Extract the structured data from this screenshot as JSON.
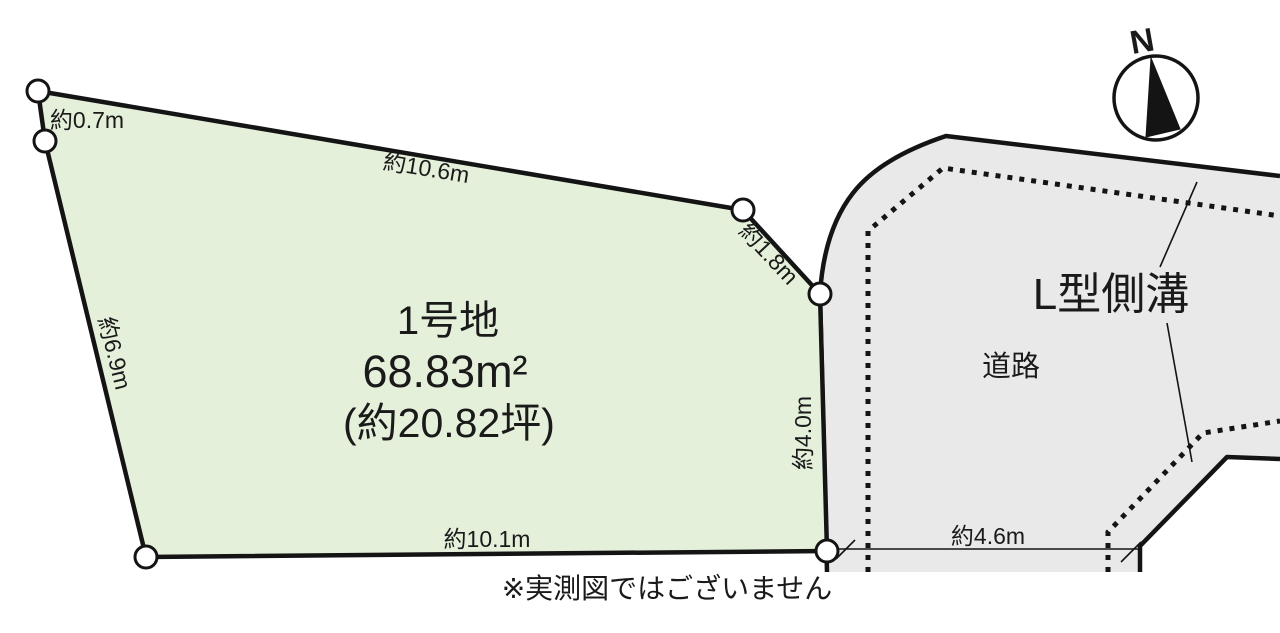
{
  "diagram": {
    "plot": {
      "name": "1号地",
      "area_m2": "68.83m²",
      "area_tsubo": "(約20.82坪)",
      "dimensions": {
        "top_left": "約0.7m",
        "top": "約10.6m",
        "top_right": "約1.8m",
        "left": "約6.9m",
        "right": "約4.0m",
        "bottom": "約10.1m"
      }
    },
    "road": {
      "label": "道路",
      "gutter_label": "L型側溝",
      "width_label": "約4.6m"
    },
    "compass": {
      "north_label": "N"
    },
    "disclaimer": "※実測図ではございません",
    "colors": {
      "plot_fill": "#e4f0da",
      "road_fill": "#e9e9e9",
      "line": "#141414"
    }
  }
}
